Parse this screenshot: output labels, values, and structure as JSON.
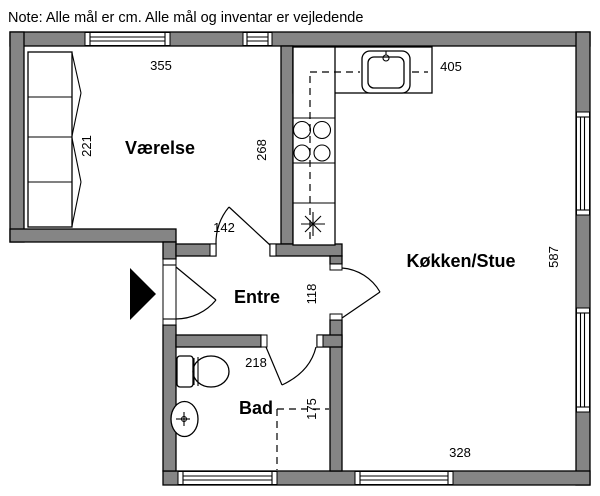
{
  "note": "Note: Alle mål er cm. Alle mål og inventar er vejledende",
  "rooms": {
    "vaerelse": {
      "label": "Værelse"
    },
    "entre": {
      "label": "Entre"
    },
    "bad": {
      "label": "Bad"
    },
    "koekken_stue": {
      "label": "Køkken/Stue"
    }
  },
  "dimensions_cm": {
    "vaerelse_width": "355",
    "vaerelse_depth": "221",
    "vaerelse_east": "268",
    "koekken_top": "405",
    "koekken_east": "587",
    "koekken_south": "328",
    "vaerelse_door": "142",
    "koekken_door": "118",
    "bad_width": "218",
    "bad_depth": "175"
  },
  "icons": {
    "entrance_arrow": "black triangle pointing right at front door",
    "kitchen_sink": "rounded square sink with faucet",
    "stove": "four burner circles",
    "appliance_star": "asterisk appliance symbol",
    "toilet": "tank with oval bowl",
    "washbasin": "oval basin with tap",
    "wardrobe": "four-section closet with door swings"
  },
  "colors": {
    "wall": "#858585",
    "outline": "#000000",
    "background": "#ffffff"
  }
}
